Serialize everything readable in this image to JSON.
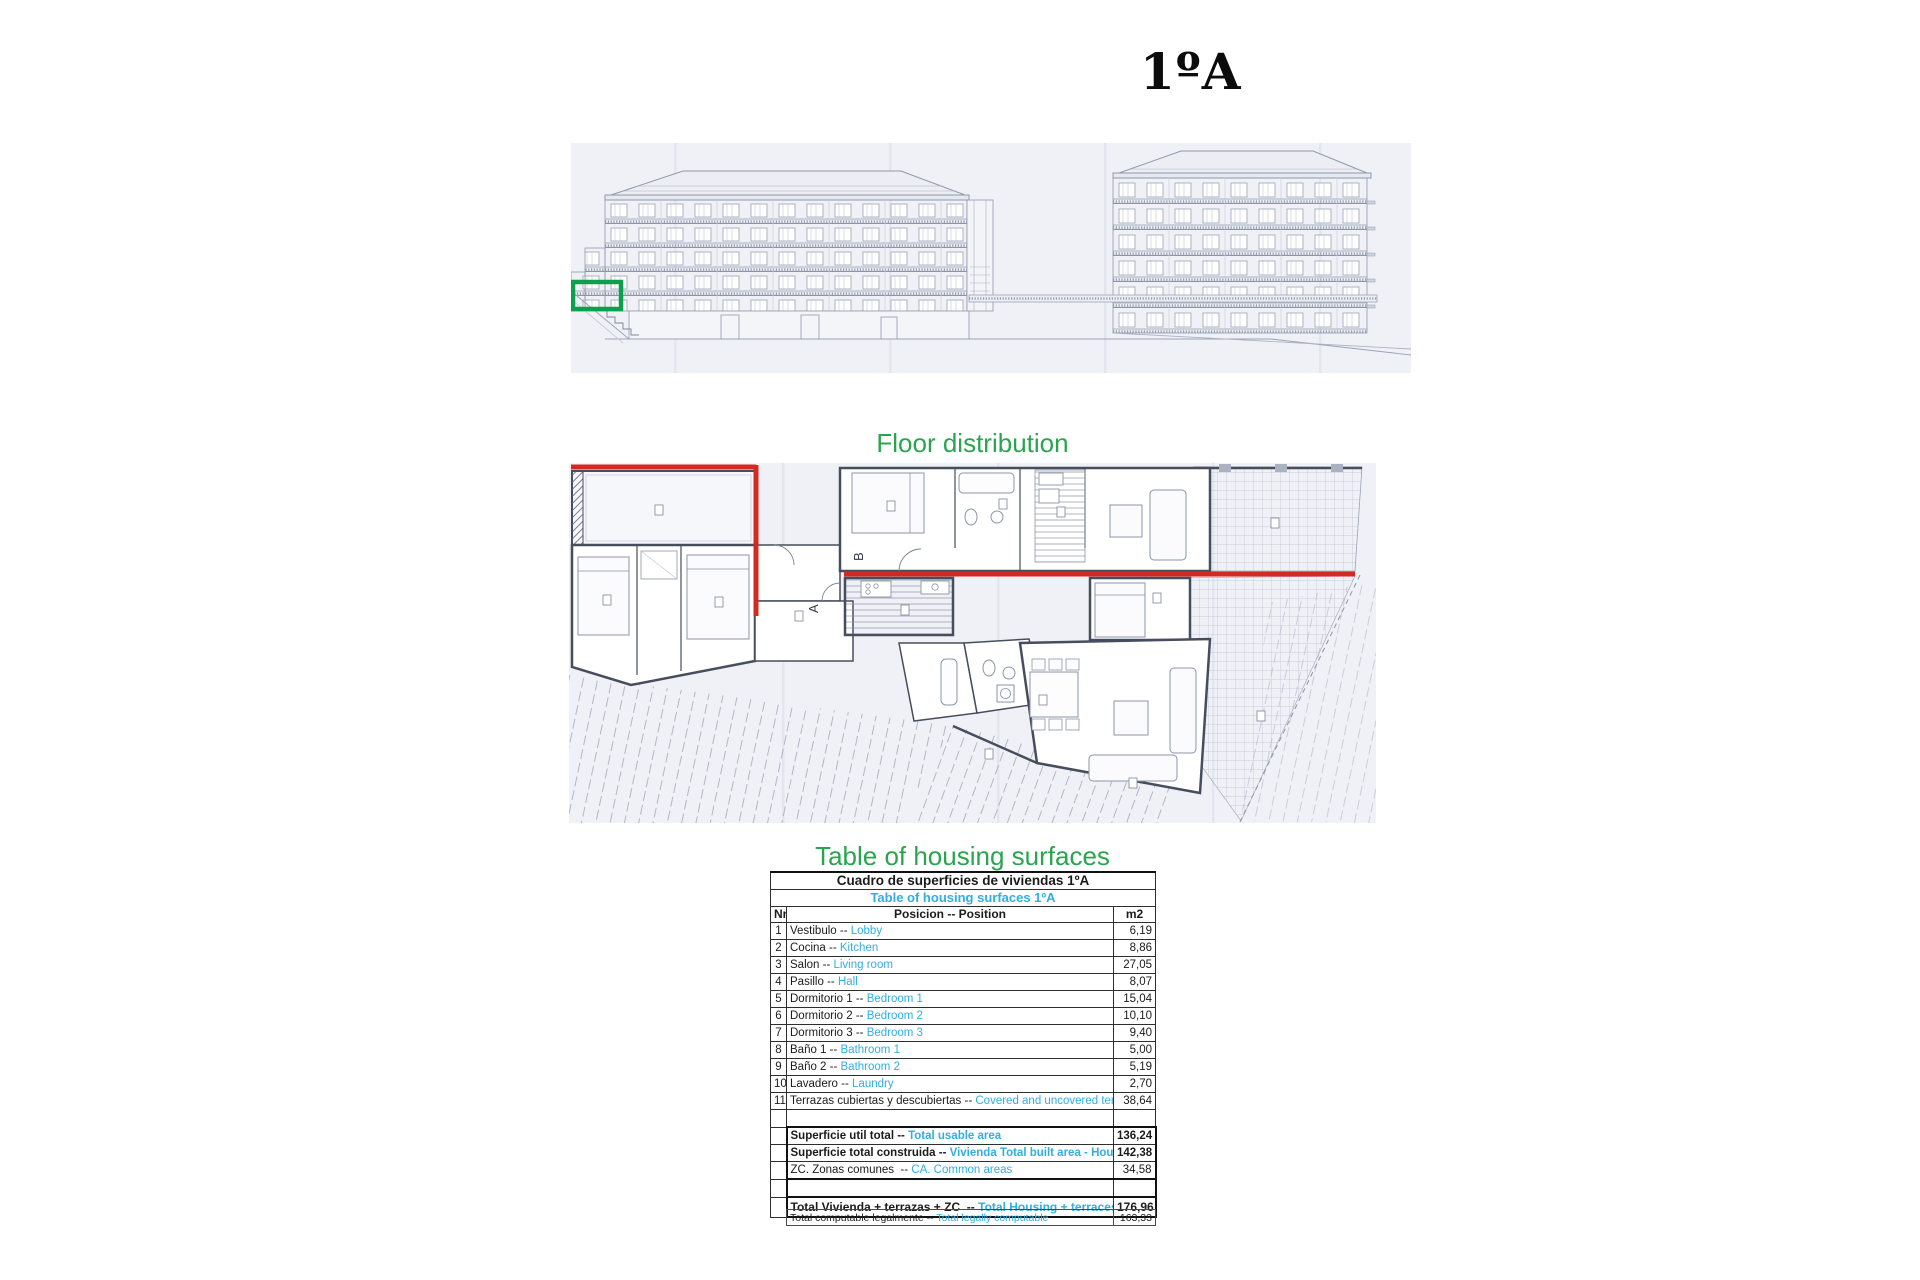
{
  "page": {
    "unit_title": "1ºA"
  },
  "elevation": {
    "description": "building-front-elevation-drawing",
    "highlight_color": "#0da04c"
  },
  "floor_plan": {
    "title": "Floor distribution",
    "label_a": "A",
    "label_b": "B",
    "boundary_color": "#d22a21"
  },
  "surface_table": {
    "title": "Table of housing surfaces",
    "title_color": "#2aa44f",
    "accent_cyan": "#31aee3",
    "header_es": "Cuadro de superficies de viviendas 1ºA",
    "header_en": "Table of housing surfaces 1ºA",
    "columns": {
      "nr": "Nr",
      "position": "Posicion -- Position",
      "area": "m2"
    },
    "sep": " -- ",
    "rows": [
      {
        "nr": "1",
        "es": "Vestibulo",
        "en": "Lobby",
        "m2": "6,19"
      },
      {
        "nr": "2",
        "es": "Cocina",
        "en": "Kitchen",
        "m2": "8,86"
      },
      {
        "nr": "3",
        "es": "Salon",
        "en": "Living room",
        "m2": "27,05"
      },
      {
        "nr": "4",
        "es": "Pasillo",
        "en": "Hall",
        "m2": "8,07"
      },
      {
        "nr": "5",
        "es": "Dormitorio 1",
        "en": "Bedroom 1",
        "m2": "15,04"
      },
      {
        "nr": "6",
        "es": "Dormitorio 2",
        "en": "Bedroom 2",
        "m2": "10,10"
      },
      {
        "nr": "7",
        "es": "Dormitorio 3",
        "en": "Bedroom 3",
        "m2": "9,40"
      },
      {
        "nr": "8",
        "es": "Baño 1",
        "en": "Bathroom 1",
        "m2": "5,00"
      },
      {
        "nr": "9",
        "es": "Baño 2",
        "en": "Bathroom 2",
        "m2": "5,19"
      },
      {
        "nr": "10",
        "es": "Lavadero",
        "en": "Laundry",
        "m2": "2,70"
      },
      {
        "nr": "11",
        "es": "Terrazas cubiertas y descubiertas",
        "en": "Covered and uncovered terraces",
        "m2": "38,64"
      }
    ],
    "totals": [
      {
        "es": "Superficie util total",
        "en": "Total usable area",
        "m2": "136,24"
      },
      {
        "es": "Superficie total construida",
        "en": "Vivienda Total built area - Housing",
        "m2": "142,38"
      },
      {
        "es": "ZC. Zonas comunes ",
        "en": "CA. Common areas",
        "m2": "34,58"
      }
    ],
    "grand_total": {
      "es": "Total Vivienda + terrazas + ZC ",
      "en": "Total Housing + terraces + CA",
      "m2": "176,96"
    },
    "footer": {
      "es": "Total computable legalmente",
      "en": "Total legally computable",
      "m2": "163,33"
    }
  }
}
